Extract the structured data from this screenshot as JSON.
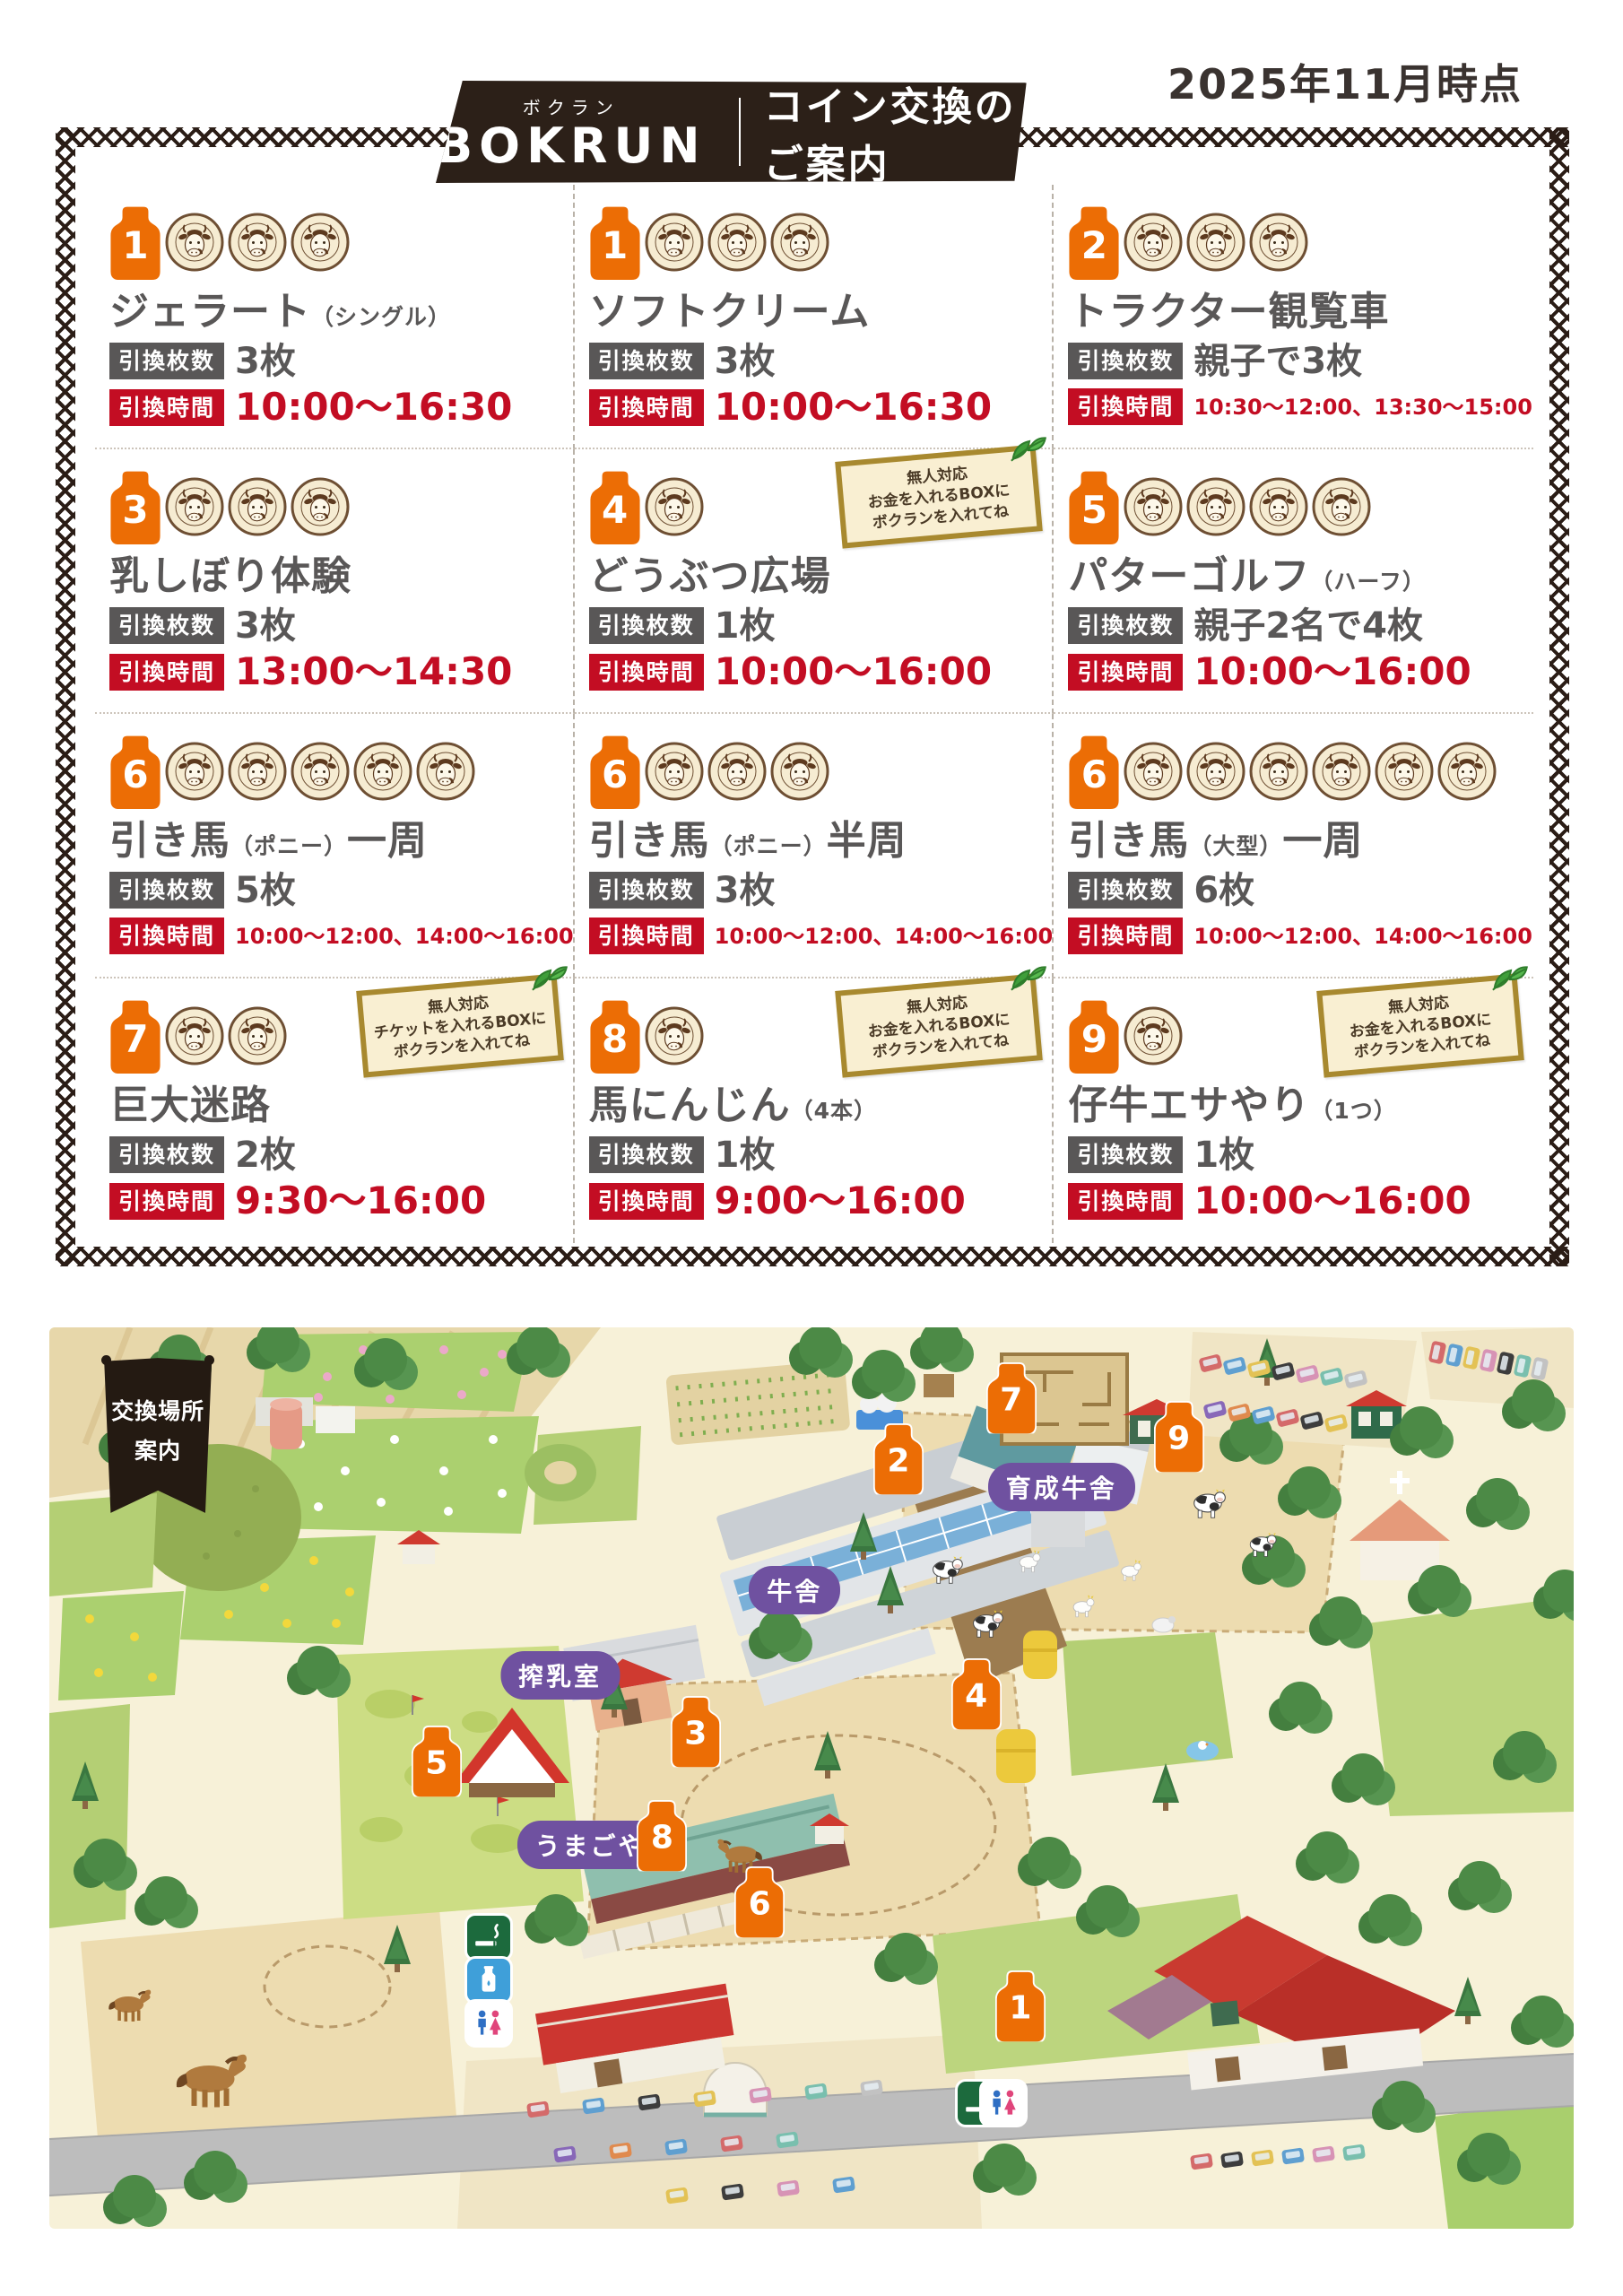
{
  "header": {
    "date_note": "2025年11月時点",
    "brand_furigana": "ボクラン",
    "brand_name": "BOKRUN",
    "title": "コイン交換のご案内"
  },
  "coin": {
    "ring_text": "AIBOKU・AIBOKU・AIBOKU"
  },
  "badges": {
    "pieces": "引換枚数",
    "time": "引換時間"
  },
  "items": [
    {
      "no": "1",
      "name": "ジェラート",
      "name_note": "（シングル）",
      "name_post": "",
      "coins": 3,
      "pieces": "3枚",
      "time": "10:00〜16:30"
    },
    {
      "no": "1",
      "name": "ソフトクリーム",
      "name_note": "",
      "name_post": "",
      "coins": 3,
      "pieces": "3枚",
      "time": "10:00〜16:30"
    },
    {
      "no": "2",
      "name": "トラクター観覧車",
      "name_note": "",
      "name_post": "",
      "coins": 3,
      "pieces": "親子で3枚",
      "time": "10:30〜12:00、13:30〜15:00"
    },
    {
      "no": "3",
      "name": "乳しぼり体験",
      "name_note": "",
      "name_post": "",
      "coins": 3,
      "pieces": "3枚",
      "time": "13:00〜14:30"
    },
    {
      "no": "4",
      "name": "どうぶつ広場",
      "name_note": "",
      "name_post": "",
      "coins": 1,
      "pieces": "1枚",
      "time": "10:00〜16:00",
      "note": [
        "無人対応",
        "お金を入れるBOXに",
        "ボクランを入れてね"
      ]
    },
    {
      "no": "5",
      "name": "パターゴルフ",
      "name_note": "（ハーフ）",
      "name_post": "",
      "coins": 4,
      "pieces": "親子2名で4枚",
      "time": "10:00〜16:00"
    },
    {
      "no": "6",
      "name": "引き馬",
      "name_note": "（ポニー）",
      "name_post": "一周",
      "coins": 5,
      "pieces": "5枚",
      "time": "10:00〜12:00、14:00〜16:00"
    },
    {
      "no": "6",
      "name": "引き馬",
      "name_note": "（ポニー）",
      "name_post": "半周",
      "coins": 3,
      "pieces": "3枚",
      "time": "10:00〜12:00、14:00〜16:00"
    },
    {
      "no": "6",
      "name": "引き馬",
      "name_note": "（大型）",
      "name_post": "一周",
      "coins": 6,
      "pieces": "6枚",
      "time": "10:00〜12:00、14:00〜16:00"
    },
    {
      "no": "7",
      "name": "巨大迷路",
      "name_note": "",
      "name_post": "",
      "coins": 2,
      "pieces": "2枚",
      "time": "9:30〜16:00",
      "note": [
        "無人対応",
        "チケットを入れるBOXに",
        "ボクランを入れてね"
      ]
    },
    {
      "no": "8",
      "name": "馬にんじん",
      "name_note": "（4本）",
      "name_post": "",
      "coins": 1,
      "pieces": "1枚",
      "time": "9:00〜16:00",
      "note": [
        "無人対応",
        "お金を入れるBOXに",
        "ボクランを入れてね"
      ]
    },
    {
      "no": "9",
      "name": "仔牛エサやり",
      "name_note": "（1つ）",
      "name_post": "",
      "coins": 1,
      "pieces": "1枚",
      "time": "10:00〜16:00",
      "note": [
        "無人対応",
        "お金を入れるBOXに",
        "ボクランを入れてね"
      ]
    }
  ],
  "map": {
    "banner": [
      "交換場所",
      "案内"
    ],
    "labels": [
      {
        "text": "育成牛舎",
        "x": 66.4,
        "y": 17.7
      },
      {
        "text": "牛舎",
        "x": 48.9,
        "y": 29.2
      },
      {
        "text": "搾乳室",
        "x": 33.5,
        "y": 38.6
      },
      {
        "text": "うまごや",
        "x": 35.5,
        "y": 57.4
      }
    ],
    "pins": [
      {
        "no": "1",
        "x": 63.7,
        "y": 75.4
      },
      {
        "no": "2",
        "x": 55.7,
        "y": 14.7
      },
      {
        "no": "3",
        "x": 42.4,
        "y": 45.0
      },
      {
        "no": "4",
        "x": 60.8,
        "y": 40.8
      },
      {
        "no": "5",
        "x": 25.4,
        "y": 48.3
      },
      {
        "no": "6",
        "x": 46.6,
        "y": 63.9
      },
      {
        "no": "7",
        "x": 63.1,
        "y": 8.0
      },
      {
        "no": "8",
        "x": 40.2,
        "y": 56.5
      },
      {
        "no": "9",
        "x": 74.1,
        "y": 12.2
      }
    ],
    "icons": [
      {
        "name": "smoking-area-icon",
        "x": 28.8,
        "y": 67.7
      },
      {
        "name": "baby-milk-icon",
        "x": 28.8,
        "y": 72.4
      },
      {
        "name": "restroom-icon",
        "x": 28.8,
        "y": 77.2
      },
      {
        "name": "smoking-area-icon",
        "x": 61.0,
        "y": 86.1
      },
      {
        "name": "restroom-icon",
        "x": 62.6,
        "y": 86.1
      }
    ]
  }
}
